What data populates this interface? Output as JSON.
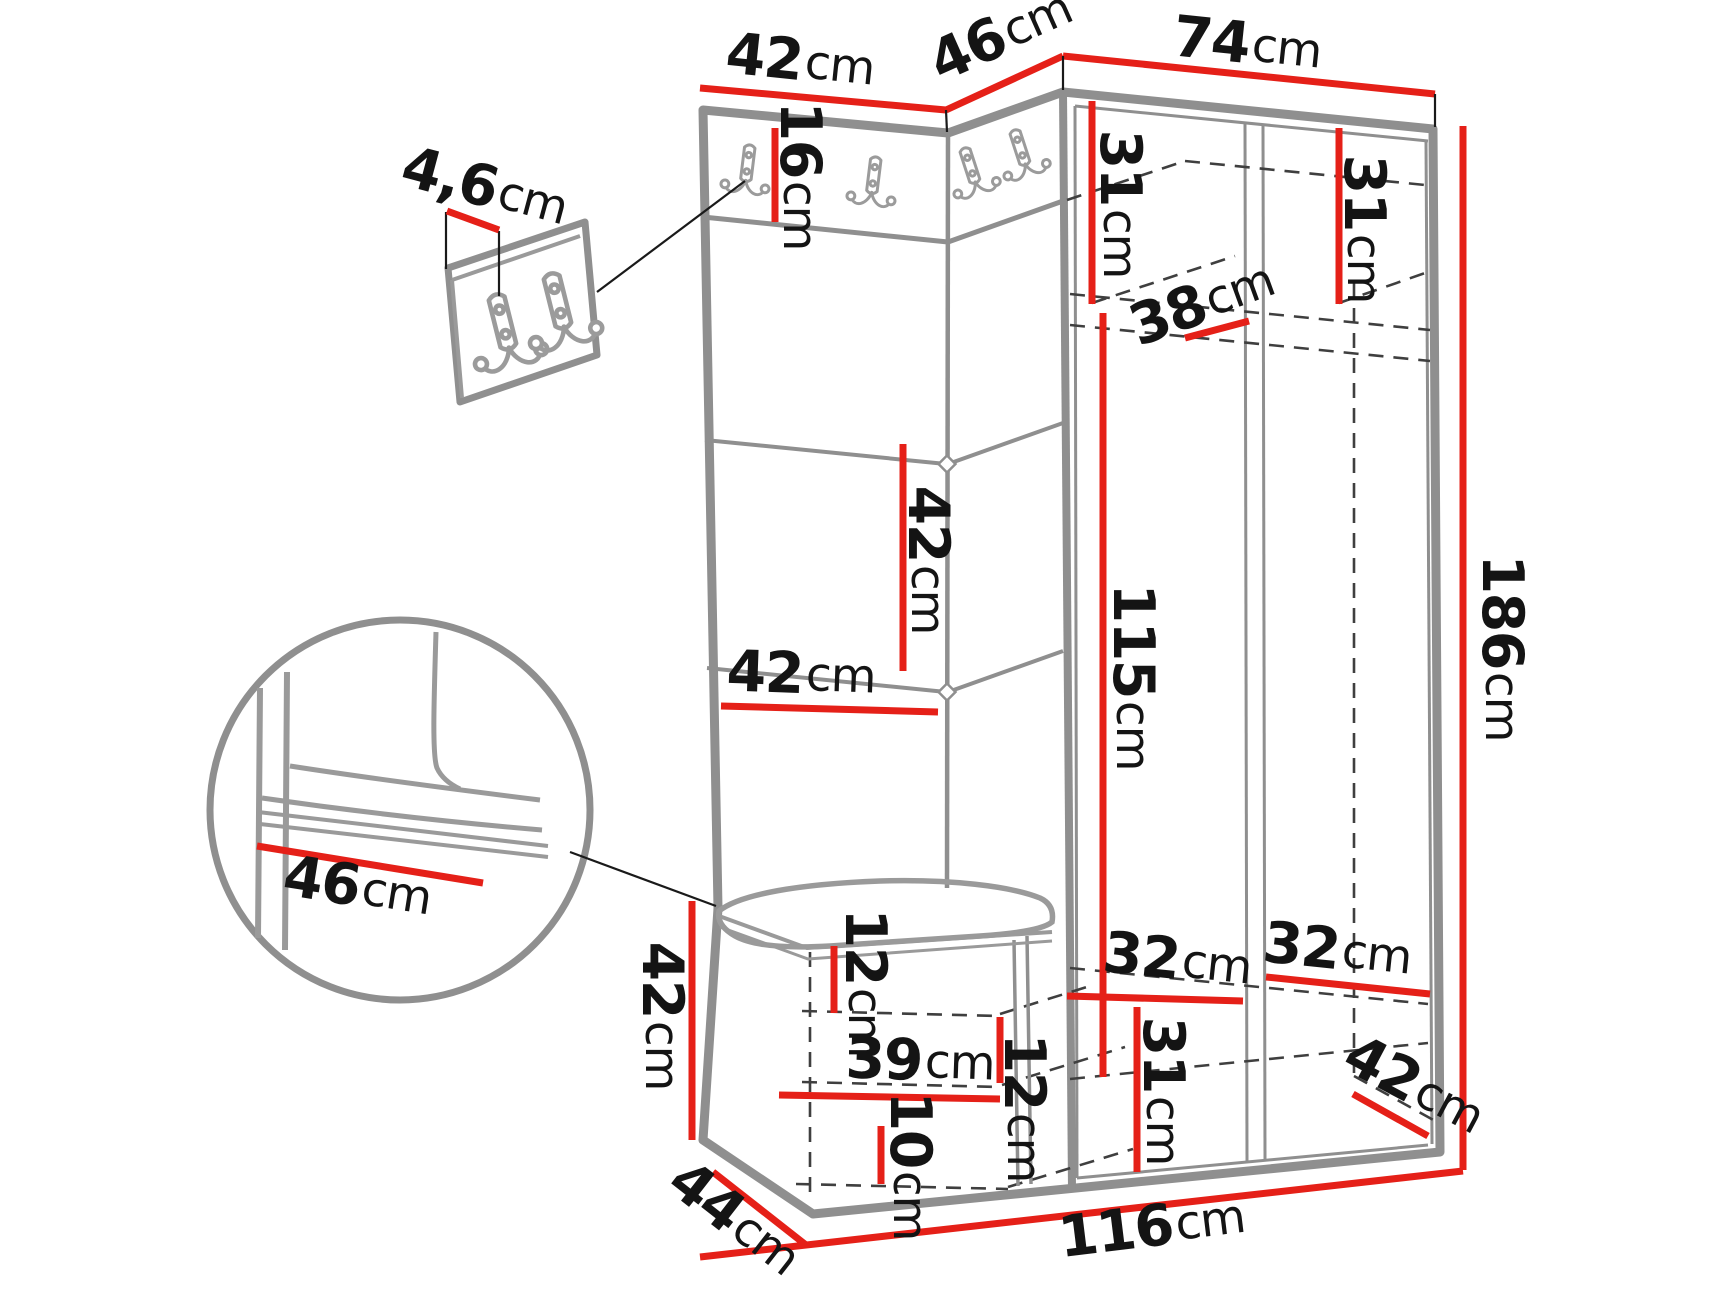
{
  "diagram": {
    "type": "furniture-dimension-drawing",
    "subject": "hallway wardrobe set with coat-hook panels, corner bench and wardrobe",
    "unit": "cm",
    "colors": {
      "dimension_line": "#e52018",
      "outline": "#8f8f8f",
      "hidden_edge": "#3f3f3f",
      "text": "#141414"
    }
  },
  "dims": {
    "top_panel_width": {
      "value": "42",
      "unit": "cm"
    },
    "top_corner_width": {
      "value": "46",
      "unit": "cm"
    },
    "top_wardrobe_width": {
      "value": "74",
      "unit": "cm"
    },
    "hook_rail_height": {
      "value": "16",
      "unit": "cm"
    },
    "left_shelf_height": {
      "value": "31",
      "unit": "cm"
    },
    "shelf_depth": {
      "value": "38",
      "unit": "cm"
    },
    "right_shelf_height": {
      "value": "31",
      "unit": "cm"
    },
    "panel_segment_height": {
      "value": "42",
      "unit": "cm"
    },
    "panel_width": {
      "value": "42",
      "unit": "cm"
    },
    "hanging_space_height": {
      "value": "115",
      "unit": "cm"
    },
    "total_height": {
      "value": "186",
      "unit": "cm"
    },
    "bench_height": {
      "value": "42",
      "unit": "cm"
    },
    "bench_depth": {
      "value": "44",
      "unit": "cm"
    },
    "bench_top_clearance": {
      "value": "12",
      "unit": "cm"
    },
    "bench_inner_width": {
      "value": "39",
      "unit": "cm"
    },
    "bench_shelf_clearance": {
      "value": "12",
      "unit": "cm"
    },
    "bench_bottom_clearance": {
      "value": "10",
      "unit": "cm"
    },
    "bottom_left_width": {
      "value": "32",
      "unit": "cm"
    },
    "bottom_right_width": {
      "value": "32",
      "unit": "cm"
    },
    "bottom_section_height": {
      "value": "31",
      "unit": "cm"
    },
    "bottom_depth": {
      "value": "42",
      "unit": "cm"
    },
    "total_width": {
      "value": "116",
      "unit": "cm"
    },
    "seat_width": {
      "value": "46",
      "unit": "cm"
    },
    "hook_panel_thickness": {
      "value": "4,6",
      "unit": "cm"
    }
  },
  "icons": {
    "coat_hook": "double-hook-icon"
  }
}
